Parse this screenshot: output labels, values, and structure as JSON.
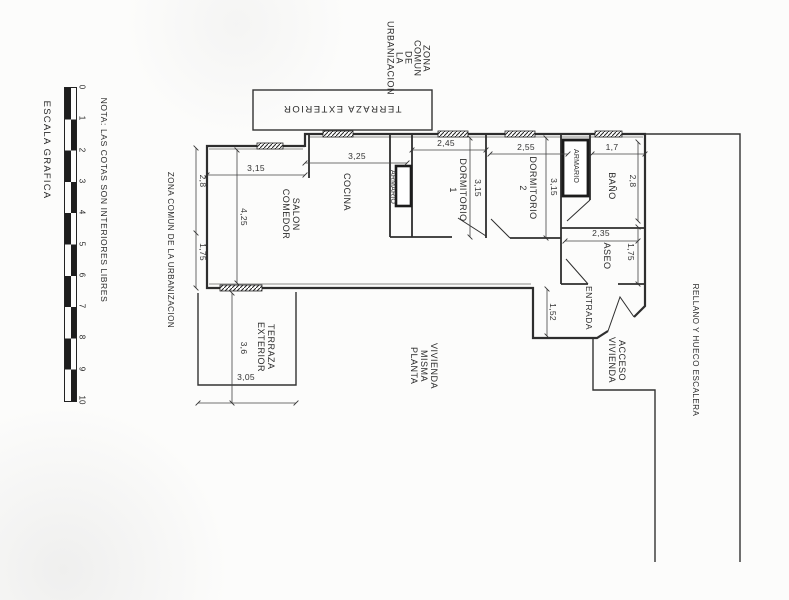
{
  "note": "NOTA: LAS COTAS SON INTERIORES LIBRES",
  "scale": {
    "label": "ESCALA GRAFICA",
    "ticks": [
      "0",
      "1",
      "2",
      "3",
      "4",
      "5",
      "6",
      "7",
      "8",
      "9",
      "10"
    ]
  },
  "areas": {
    "zona_comun_top": "ZONA\nCOMUN\nDE\nLA\nURBANIZACION",
    "zona_comun_left": "ZONA COMUN DE LA URBANIZACION",
    "terraza_superior": "TERRAZA EXTERIOR",
    "salon": "SALON\nCOMEDOR",
    "cocina": "COCINA",
    "armario_pasillo": "ARMARIO",
    "dormitorio1": "DORMITORIO\n1",
    "dormitorio2": "DORMITORIO\n2",
    "armario_bano": "ARMARIO",
    "bano": "BAÑO",
    "aseo": "ASEO",
    "entrada": "ENTRADA",
    "terraza_exterior": "TERRAZA\nEXTERIOR",
    "vivienda_misma_planta": "VIVIENDA\nMISMA\nPLANTA",
    "acceso_vivienda": "ACCESO\nVIVIENDA",
    "rellano": "RELLANO Y HUECO ESCALERA"
  },
  "dimensions": {
    "salon_ancho": "3,15",
    "cocina_ancho": "3,25",
    "dorm1_ancho": "2,45",
    "dorm2_ancho": "2,55",
    "bano_ancho": "1,7",
    "aseo_ancho": "2,35",
    "terraza_ancho": "3,05",
    "salon_alto_sup": "2,8",
    "salon_alto": "4,25",
    "salon_alto_inf": "1,75",
    "dorm1_alto": "3,15",
    "dorm2_alto": "3,15",
    "bano_alto": "2,8",
    "aseo_alto": "1,75",
    "entrada_alto": "1,52",
    "terraza_alto": "3,6"
  }
}
